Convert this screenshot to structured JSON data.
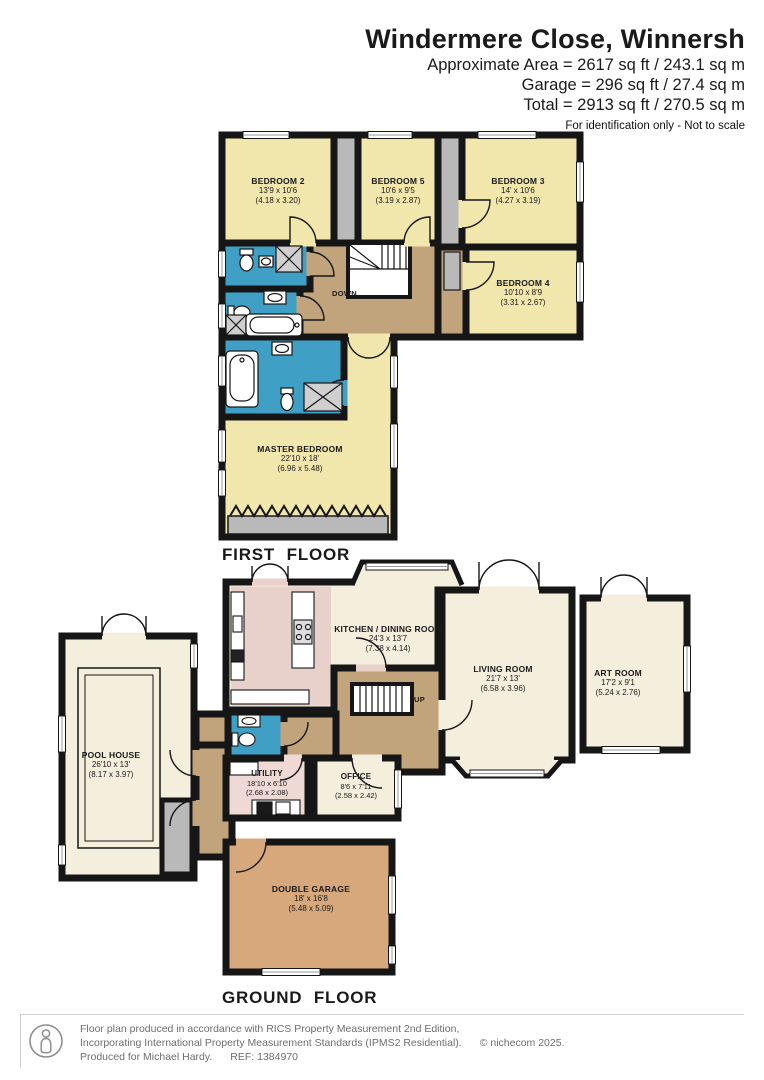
{
  "header": {
    "title": "Windermere Close, Winnersh",
    "area_line": "Approximate Area = 2617 sq ft / 243.1 sq m",
    "garage_line": "Garage = 296 sq ft / 27.4 sq m",
    "total_line": "Total = 2913 sq ft / 270.5 sq m",
    "disclaimer": "For identification only - Not to scale"
  },
  "floors": {
    "first": {
      "label": "FIRST FLOOR",
      "stairs_label": "DOWN",
      "rooms": {
        "bedroom2": {
          "name": "BEDROOM 2",
          "imperial": "13'9 x 10'6",
          "metric": "(4.18 x 3.20)"
        },
        "bedroom5": {
          "name": "BEDROOM 5",
          "imperial": "10'6 x 9'5",
          "metric": "(3.19 x 2.87)"
        },
        "bedroom3": {
          "name": "BEDROOM 3",
          "imperial": "14' x 10'6",
          "metric": "(4.27 x 3.19)"
        },
        "bedroom4": {
          "name": "BEDROOM 4",
          "imperial": "10'10 x 8'9",
          "metric": "(3.31 x 2.67)"
        },
        "master": {
          "name": "MASTER BEDROOM",
          "imperial": "22'10 x 18'",
          "metric": "(6.96 x 5.48)"
        }
      }
    },
    "ground": {
      "label": "GROUND FLOOR",
      "stairs_label": "UP",
      "rooms": {
        "kitchen": {
          "name": "KITCHEN / DINING ROOM",
          "imperial": "24'3 x 13'7",
          "metric": "(7.38 x 4.14)"
        },
        "living": {
          "name": "LIVING ROOM",
          "imperial": "21'7 x 13'",
          "metric": "(6.58 x 3.96)"
        },
        "art": {
          "name": "ART ROOM",
          "imperial": "17'2 x 9'1",
          "metric": "(5.24 x 2.76)"
        },
        "pool": {
          "name": "POOL HOUSE",
          "imperial": "26'10 x 13'",
          "metric": "(8.17 x 3.97)"
        },
        "utility": {
          "name": "UTILITY",
          "imperial": "18'10 x 6'10",
          "metric": "(2.68 x 2.08)"
        },
        "office": {
          "name": "OFFICE",
          "imperial": "8'6 x 7'11",
          "metric": "(2.58 x 2.42)"
        },
        "garage": {
          "name": "DOUBLE GARAGE",
          "imperial": "18' x 16'8",
          "metric": "(5.48 x 5.09)"
        }
      }
    }
  },
  "footer": {
    "line1": "Floor plan produced in accordance with RICS Property Measurement 2nd Edition,",
    "line2": "Incorporating International Property Measurement Standards (IPMS2 Residential).",
    "copyright": "© nichecom 2025.",
    "line3": "Produced for Michael Hardy.",
    "ref": "REF: 1384970",
    "logo_icon": "person-logo-icon"
  },
  "colors": {
    "wall": "#161616",
    "bedroom_fill": "#f1e6ac",
    "bathroom_fill": "#3f9fc5",
    "hall_fill": "#c2a47c",
    "room_fill": "#f4eedd",
    "kitchen_fill": "#e8d0cb",
    "utility_fill": "#efd9d4",
    "garage_fill": "#d7a87b",
    "wardrobe_gray": "#b9b9b9"
  }
}
